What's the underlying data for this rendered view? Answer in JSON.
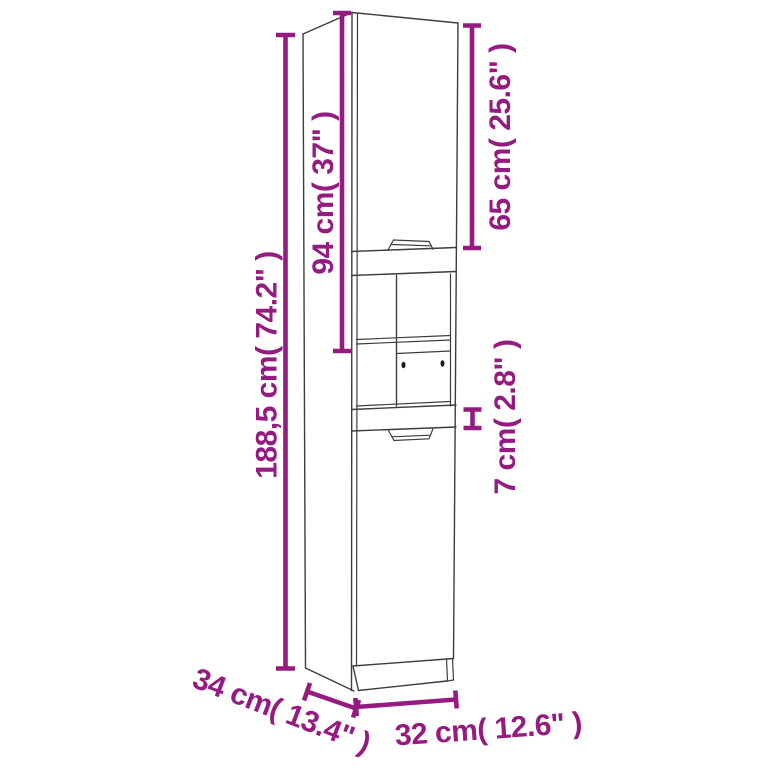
{
  "diagram": {
    "subject": "tall-bathroom-cabinet-dimension-drawing",
    "colors": {
      "annotation": "#951b81",
      "outline": "#3d3d3c",
      "background": "#ffffff"
    },
    "dimensions": {
      "overall_height": {
        "label": "188,5 cm( 74.2\" )",
        "cm": "188,5",
        "inches": "74.2"
      },
      "upper_section_height": {
        "label": "94 cm( 37\" )",
        "cm": "94",
        "inches": "37"
      },
      "upper_door_height": {
        "label": "65 cm( 25.6\" )",
        "cm": "65",
        "inches": "25.6"
      },
      "middle_rail_height": {
        "label": "7 cm( 2.8\" )",
        "cm": "7",
        "inches": "2.8"
      },
      "depth": {
        "label": "34 cm( 13.4\" )",
        "cm": "34",
        "inches": "13.4"
      },
      "width": {
        "label": "32 cm( 12.6\" )",
        "cm": "32",
        "inches": "12.6"
      }
    }
  }
}
